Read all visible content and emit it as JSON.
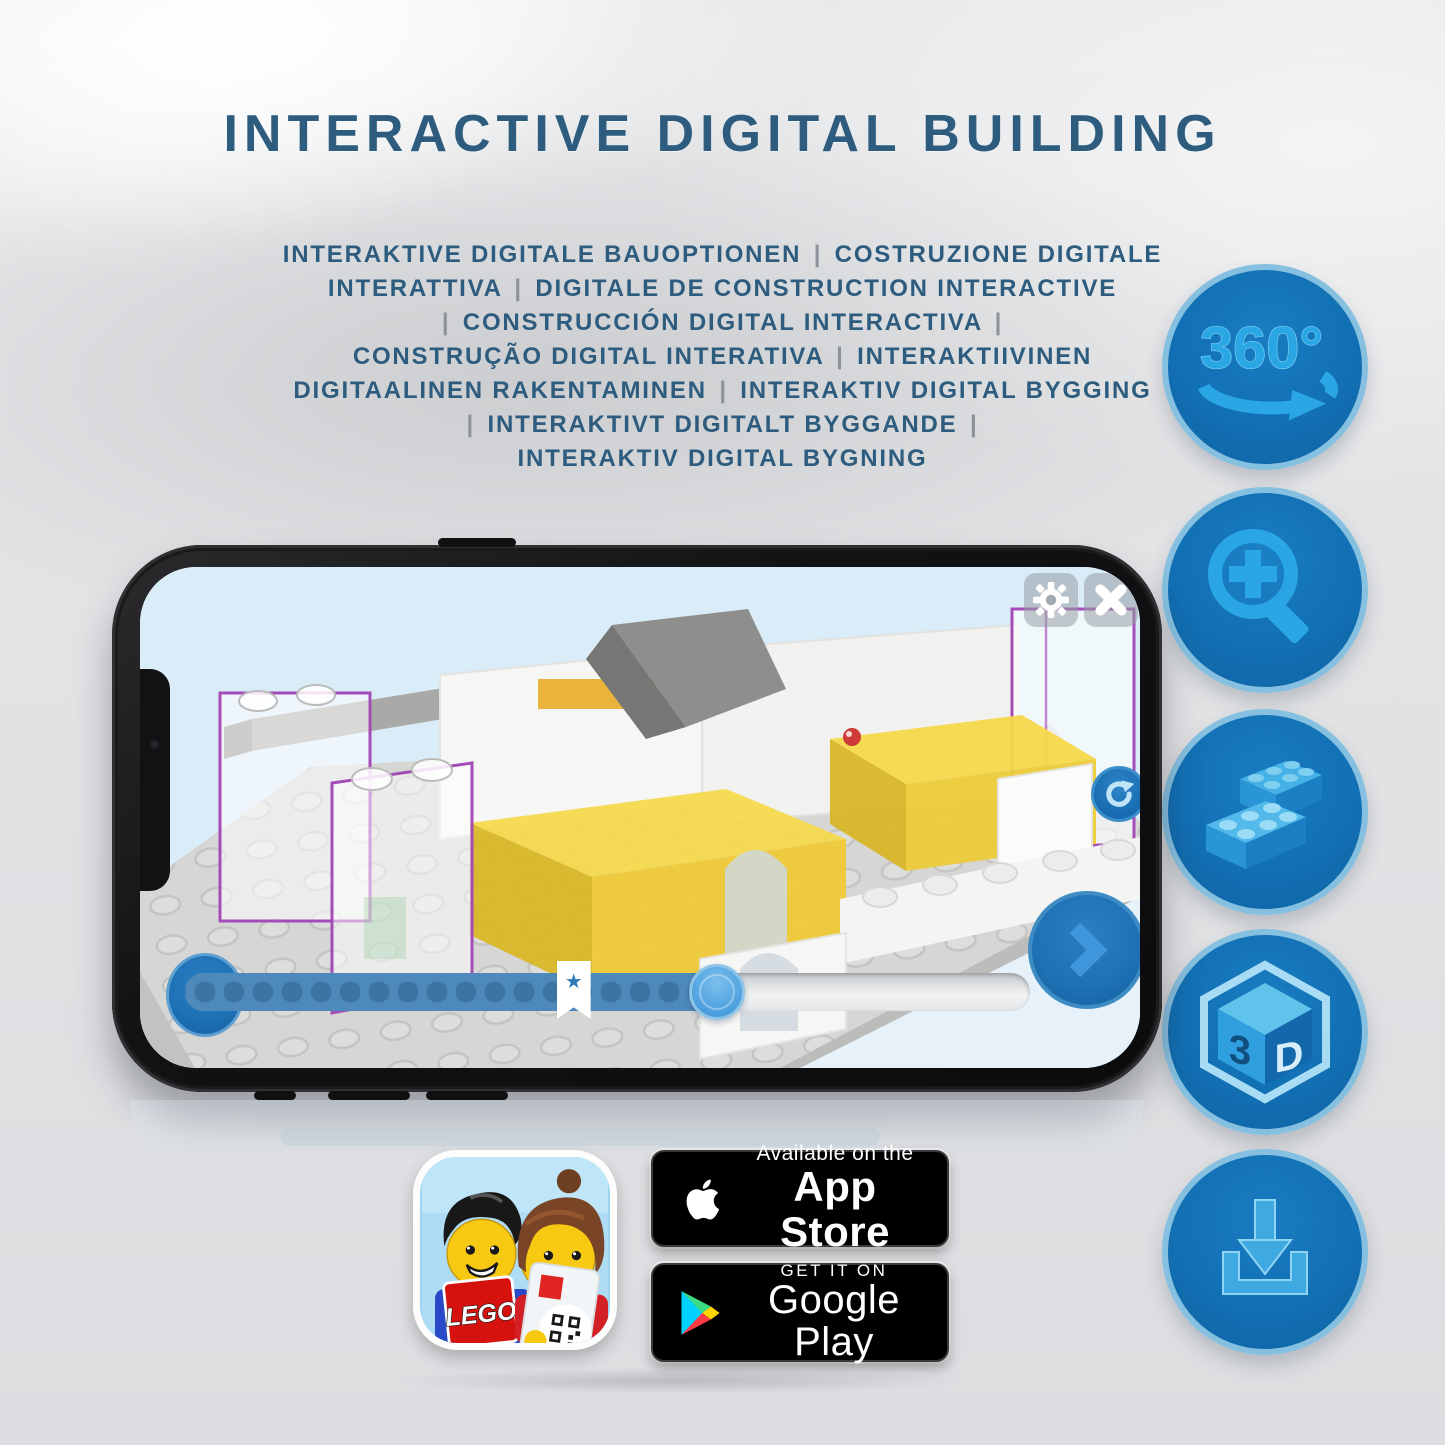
{
  "title": "INTERACTIVE DIGITAL BUILDING",
  "languages": [
    "INTERAKTIVE DIGITALE BAUOPTIONEN | COSTRUZIONE DIGITALE",
    "INTERATTIVA | DIGITALE DE CONSTRUCTION INTERACTIVE",
    "| CONSTRUCCIÓN DIGITAL INTERACTIVA |",
    "CONSTRUÇÃO DIGITAL INTERATIVA | INTERAKTIIVINEN",
    "DIGITAALINEN RAKENTAMINEN | INTERAKTIV DIGITAL BYGGING",
    "| INTERAKTIVT DIGITALT BYGGANDE |",
    "INTERAKTIV DIGITAL BYGNING"
  ],
  "features": {
    "rotate360": {
      "label": "360°"
    },
    "zoom": {
      "name": "magnifier-plus"
    },
    "brick": {
      "name": "lego-bricks"
    },
    "cube3d": {
      "left": "3",
      "right": "D"
    },
    "download": {
      "name": "download-tray"
    }
  },
  "phone": {
    "progress": {
      "fill_percent": 63,
      "bookmark_percent": 46,
      "knob_percent": 63
    },
    "bookmark_star": "★"
  },
  "badges": {
    "app_store": {
      "line1": "Available on the",
      "line2": "App Store"
    },
    "google_play": {
      "line1": "GET IT ON",
      "line2": "Google Play"
    },
    "lego_logo": "LEGO"
  },
  "colors": {
    "headline": "#2d5c7f",
    "separator": "#8d939a",
    "circle_fill": "#1270b4",
    "circle_border": "#86c0e0",
    "glyph_blue": "#2ba6e4",
    "ui_button_blue": "#1d71b4",
    "knob_blue": "#55a6e2",
    "yellow_brick": "#f3d64a",
    "ghost_outline_purple": "#a54db6"
  }
}
